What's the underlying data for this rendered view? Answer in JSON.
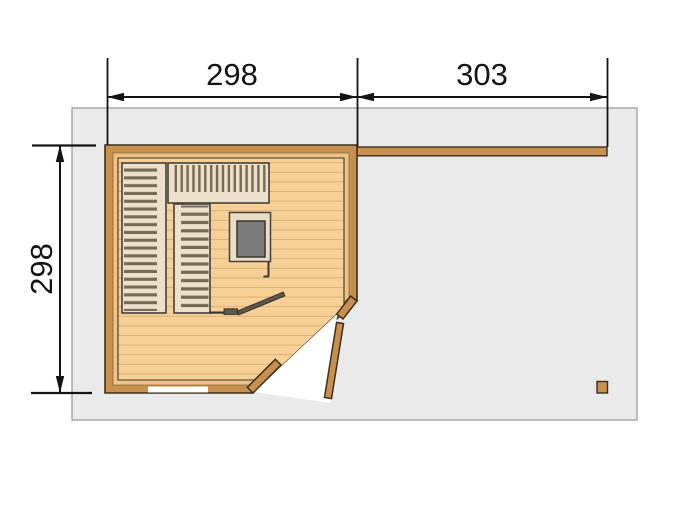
{
  "floor_plan": {
    "title": "sauna-cabin-floor-plan",
    "dimensions": {
      "top_left": "298",
      "top_right": "303",
      "left": "298"
    },
    "colors": {
      "platform": "#eaeaea",
      "platform_border": "#9c9c9c",
      "wall_wood": "#c8904e",
      "wall_outline": "#3c2f1d",
      "inner_trim": "#ecc489",
      "floor_wood": "#f6d096",
      "floor_plank_line": "#ddb476",
      "bench_slat": "#ece0cb",
      "bench_slat_gap": "#756a56",
      "window_pane": "#7a7a7a",
      "sauna_door": "#5f584c",
      "door_swing_area": "#ffffff",
      "dimension_ink": "#141414"
    }
  }
}
